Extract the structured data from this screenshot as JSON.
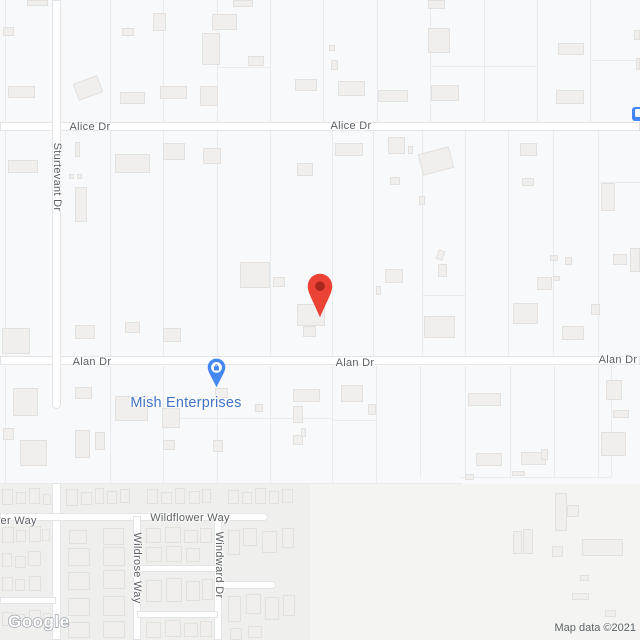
{
  "map": {
    "background": "#f8f9fa",
    "road_fill": "#ffffff",
    "road_casing": "#e3e4e6",
    "building_fill": "#f0efed",
    "building_stroke": "#e3e1de",
    "parcel_line_color": "#e9ebee",
    "street_label_color": "#5d6063"
  },
  "zones": [
    {
      "x": 0,
      "y": 484,
      "w": 640,
      "h": 156,
      "color": "#f4f5f3"
    },
    {
      "x": 0,
      "y": 484,
      "w": 310,
      "h": 156,
      "color": "#efefed"
    }
  ],
  "roads": [
    {
      "name": "Alice Dr",
      "dir": "h",
      "x": 0,
      "y": 122,
      "len": 640,
      "w": 9
    },
    {
      "name": "Alan Dr",
      "dir": "h",
      "x": 0,
      "y": 356,
      "len": 640,
      "w": 9
    },
    {
      "name": "Sturtevant Dr",
      "dir": "v",
      "x": 52,
      "y": 0,
      "len": 409,
      "w": 9,
      "cap": "end"
    },
    {
      "name": "Sturtevant Dr south",
      "dir": "v",
      "x": 52,
      "y": 483,
      "len": 157,
      "w": 9
    },
    {
      "name": "Wildflower Way",
      "dir": "h",
      "x": 0,
      "y": 513,
      "len": 268,
      "w": 8,
      "cap": "end"
    },
    {
      "name": "Wildrose Way",
      "dir": "v",
      "x": 133,
      "y": 516,
      "len": 124,
      "w": 8
    },
    {
      "name": "Windward Dr",
      "dir": "v",
      "x": 214,
      "y": 516,
      "len": 124,
      "w": 8
    },
    {
      "name": "Windward stub",
      "dir": "h",
      "x": 218,
      "y": 581,
      "len": 58,
      "w": 8,
      "cap": "end"
    },
    {
      "name": "lane north",
      "dir": "h",
      "x": 137,
      "y": 565,
      "len": 81,
      "w": 7
    },
    {
      "name": "lane south",
      "dir": "h",
      "x": 137,
      "y": 611,
      "len": 81,
      "w": 7
    },
    {
      "name": "lane west",
      "dir": "h",
      "x": 0,
      "y": 597,
      "len": 56,
      "w": 7
    }
  ],
  "road_labels": [
    {
      "text": "Alice Dr",
      "x": 90,
      "y": 127
    },
    {
      "text": "Alice Dr",
      "x": 351,
      "y": 126
    },
    {
      "text": "Sturtevant Dr",
      "x": 57,
      "y": 177,
      "vertical": true
    },
    {
      "text": "Alan Dr",
      "x": 92,
      "y": 362
    },
    {
      "text": "Alan Dr",
      "x": 355,
      "y": 363
    },
    {
      "text": "Alan Dr",
      "x": 618,
      "y": 360
    },
    {
      "text": "Wildflower Way",
      "x": -3,
      "y": 521
    },
    {
      "text": "Wildflower Way",
      "x": 190,
      "y": 518
    },
    {
      "text": "Wildrose Way",
      "x": 137,
      "y": 568,
      "vertical": true
    },
    {
      "text": "Windward Dr",
      "x": 219,
      "y": 565,
      "vertical": true
    }
  ],
  "poi": {
    "name": "Mish Enterprises",
    "label_x": 186,
    "label_y": 403,
    "label_color": "#4274c4",
    "pin_x": 207,
    "pin_y": 358,
    "pin_color": "#4688f1",
    "pin_icon": "shopping-bag"
  },
  "marker": {
    "x": 307,
    "y": 273,
    "color": "#EA4335",
    "dot_color": "#A6281C"
  },
  "transit_icon": {
    "x": 632,
    "y": 107,
    "w": 14,
    "h": 14,
    "color": "#4285f4"
  },
  "watermark": "Google",
  "attribution": "Map data ©2021",
  "parcel_lines": [
    [
      5,
      0,
      5,
      122
    ],
    [
      110,
      0,
      110,
      122
    ],
    [
      163,
      0,
      163,
      122
    ],
    [
      217,
      0,
      217,
      122
    ],
    [
      270,
      0,
      270,
      122
    ],
    [
      323,
      0,
      323,
      122
    ],
    [
      377,
      0,
      377,
      122
    ],
    [
      430,
      0,
      430,
      122
    ],
    [
      484,
      0,
      484,
      122
    ],
    [
      537,
      0,
      537,
      122
    ],
    [
      590,
      0,
      590,
      122
    ],
    [
      217,
      67,
      270,
      67
    ],
    [
      430,
      66,
      537,
      66
    ],
    [
      590,
      60,
      640,
      60
    ],
    [
      5,
      131,
      5,
      356
    ],
    [
      110,
      131,
      110,
      356
    ],
    [
      163,
      131,
      163,
      356
    ],
    [
      217,
      131,
      217,
      356
    ],
    [
      270,
      131,
      270,
      356
    ],
    [
      332,
      131,
      332,
      356
    ],
    [
      373,
      131,
      373,
      356
    ],
    [
      422,
      131,
      422,
      356
    ],
    [
      465,
      131,
      465,
      356
    ],
    [
      508,
      131,
      508,
      356
    ],
    [
      553,
      131,
      553,
      356
    ],
    [
      598,
      131,
      598,
      356
    ],
    [
      598,
      182,
      640,
      182
    ],
    [
      422,
      295,
      465,
      295
    ],
    [
      5,
      366,
      5,
      483
    ],
    [
      110,
      366,
      110,
      483
    ],
    [
      163,
      366,
      163,
      483
    ],
    [
      217,
      366,
      217,
      483
    ],
    [
      270,
      366,
      270,
      483
    ],
    [
      332,
      366,
      332,
      483
    ],
    [
      376,
      366,
      376,
      483
    ],
    [
      420,
      366,
      420,
      477
    ],
    [
      465,
      366,
      465,
      477
    ],
    [
      510,
      366,
      510,
      477
    ],
    [
      554,
      366,
      554,
      477
    ],
    [
      598,
      366,
      598,
      477
    ],
    [
      611,
      366,
      611,
      477
    ],
    [
      163,
      418,
      332,
      418
    ],
    [
      332,
      420,
      376,
      420
    ],
    [
      460,
      477,
      611,
      477
    ],
    [
      0,
      483,
      462,
      483
    ]
  ],
  "buildings": [
    [
      27,
      0,
      21,
      6
    ],
    [
      233,
      0,
      20,
      7
    ],
    [
      428,
      0,
      17,
      9
    ],
    [
      3,
      27,
      11,
      9
    ],
    [
      8,
      86,
      27,
      12
    ],
    [
      122,
      28,
      12,
      8
    ],
    [
      120,
      92,
      25,
      12
    ],
    [
      153,
      13,
      13,
      18
    ],
    [
      75,
      79,
      26,
      18,
      -20
    ],
    [
      160,
      86,
      27,
      13
    ],
    [
      202,
      33,
      18,
      32
    ],
    [
      212,
      14,
      25,
      16
    ],
    [
      200,
      86,
      18,
      20
    ],
    [
      248,
      56,
      16,
      10
    ],
    [
      295,
      79,
      22,
      12
    ],
    [
      428,
      28,
      22,
      25
    ],
    [
      329,
      45,
      6,
      6
    ],
    [
      331,
      60,
      7,
      10
    ],
    [
      338,
      81,
      27,
      15
    ],
    [
      378,
      90,
      30,
      12
    ],
    [
      431,
      85,
      28,
      16
    ],
    [
      558,
      43,
      26,
      12
    ],
    [
      556,
      90,
      28,
      14
    ],
    [
      634,
      30,
      6,
      10
    ],
    [
      636,
      58,
      4,
      12
    ],
    [
      8,
      160,
      30,
      13
    ],
    [
      75,
      142,
      5,
      15
    ],
    [
      69,
      174,
      5,
      5
    ],
    [
      77,
      174,
      5,
      5
    ],
    [
      75,
      187,
      12,
      35
    ],
    [
      115,
      154,
      35,
      19
    ],
    [
      163,
      143,
      22,
      17
    ],
    [
      203,
      148,
      18,
      16
    ],
    [
      297,
      163,
      16,
      13
    ],
    [
      335,
      143,
      28,
      13
    ],
    [
      388,
      137,
      17,
      17
    ],
    [
      408,
      146,
      5,
      8
    ],
    [
      420,
      150,
      32,
      22,
      -15
    ],
    [
      390,
      177,
      10,
      8
    ],
    [
      419,
      196,
      6,
      9
    ],
    [
      520,
      143,
      17,
      13
    ],
    [
      522,
      178,
      12,
      8
    ],
    [
      601,
      183,
      14,
      28
    ],
    [
      240,
      262,
      30,
      26
    ],
    [
      273,
      277,
      12,
      10
    ],
    [
      297,
      304,
      28,
      22
    ],
    [
      303,
      326,
      13,
      11
    ],
    [
      385,
      269,
      18,
      14
    ],
    [
      376,
      286,
      5,
      9
    ],
    [
      437,
      250,
      7,
      10,
      20
    ],
    [
      438,
      264,
      9,
      13
    ],
    [
      424,
      316,
      31,
      22
    ],
    [
      513,
      303,
      25,
      21
    ],
    [
      562,
      326,
      22,
      14
    ],
    [
      591,
      304,
      9,
      11
    ],
    [
      537,
      277,
      15,
      13
    ],
    [
      550,
      255,
      8,
      6
    ],
    [
      565,
      257,
      7,
      8
    ],
    [
      553,
      276,
      7,
      5
    ],
    [
      613,
      254,
      14,
      11
    ],
    [
      630,
      248,
      10,
      24
    ],
    [
      75,
      325,
      20,
      14
    ],
    [
      125,
      322,
      15,
      11
    ],
    [
      163,
      328,
      18,
      14
    ],
    [
      2,
      328,
      28,
      26
    ],
    [
      13,
      388,
      25,
      28
    ],
    [
      3,
      428,
      11,
      12
    ],
    [
      20,
      440,
      27,
      26
    ],
    [
      75,
      387,
      17,
      12
    ],
    [
      75,
      430,
      15,
      28
    ],
    [
      95,
      432,
      10,
      18
    ],
    [
      163,
      440,
      12,
      10
    ],
    [
      115,
      396,
      33,
      25
    ],
    [
      162,
      408,
      18,
      20
    ],
    [
      215,
      388,
      13,
      10
    ],
    [
      213,
      440,
      10,
      12
    ],
    [
      255,
      404,
      8,
      8
    ],
    [
      293,
      406,
      10,
      17
    ],
    [
      293,
      435,
      10,
      10
    ],
    [
      293,
      389,
      27,
      13
    ],
    [
      341,
      385,
      22,
      17
    ],
    [
      368,
      404,
      8,
      11
    ],
    [
      301,
      428,
      5,
      9
    ],
    [
      468,
      393,
      33,
      13
    ],
    [
      476,
      453,
      26,
      13
    ],
    [
      521,
      452,
      25,
      13
    ],
    [
      541,
      449,
      7,
      11
    ],
    [
      512,
      471,
      13,
      5
    ],
    [
      465,
      474,
      9,
      6
    ],
    [
      606,
      380,
      16,
      20
    ],
    [
      613,
      410,
      16,
      8
    ],
    [
      601,
      432,
      25,
      24
    ],
    [
      555,
      493,
      12,
      38
    ],
    [
      567,
      505,
      12,
      12
    ],
    [
      513,
      531,
      9,
      23
    ],
    [
      523,
      529,
      10,
      25
    ],
    [
      552,
      546,
      11,
      11
    ],
    [
      582,
      539,
      41,
      17
    ],
    [
      580,
      575,
      9,
      6
    ],
    [
      572,
      593,
      17,
      7
    ],
    [
      605,
      610,
      11,
      7
    ],
    [
      2,
      489,
      11,
      16
    ],
    [
      16,
      492,
      10,
      12
    ],
    [
      29,
      488,
      11,
      16
    ],
    [
      43,
      494,
      8,
      11
    ],
    [
      66,
      489,
      12,
      17
    ],
    [
      81,
      492,
      11,
      13
    ],
    [
      95,
      488,
      9,
      16
    ],
    [
      107,
      491,
      10,
      13
    ],
    [
      120,
      489,
      10,
      14
    ],
    [
      147,
      489,
      11,
      15
    ],
    [
      161,
      492,
      11,
      12
    ],
    [
      175,
      488,
      10,
      16
    ],
    [
      189,
      491,
      11,
      13
    ],
    [
      202,
      489,
      9,
      14
    ],
    [
      228,
      490,
      11,
      14
    ],
    [
      242,
      492,
      10,
      12
    ],
    [
      255,
      488,
      11,
      16
    ],
    [
      269,
      491,
      10,
      13
    ],
    [
      282,
      489,
      11,
      14
    ],
    [
      2,
      527,
      12,
      16
    ],
    [
      16,
      530,
      10,
      12
    ],
    [
      29,
      526,
      12,
      16
    ],
    [
      42,
      529,
      8,
      12
    ],
    [
      2,
      553,
      10,
      14
    ],
    [
      15,
      556,
      11,
      12
    ],
    [
      28,
      551,
      13,
      15
    ],
    [
      2,
      577,
      11,
      14
    ],
    [
      15,
      579,
      10,
      12
    ],
    [
      29,
      576,
      12,
      15
    ],
    [
      2,
      612,
      11,
      14
    ],
    [
      15,
      614,
      10,
      12
    ],
    [
      29,
      610,
      12,
      16
    ],
    [
      43,
      613,
      8,
      11
    ],
    [
      69,
      530,
      18,
      14
    ],
    [
      103,
      528,
      21,
      17
    ],
    [
      68,
      548,
      22,
      18
    ],
    [
      103,
      547,
      22,
      19
    ],
    [
      68,
      572,
      22,
      18
    ],
    [
      103,
      570,
      22,
      19
    ],
    [
      68,
      598,
      22,
      18
    ],
    [
      103,
      596,
      22,
      20
    ],
    [
      68,
      622,
      22,
      16
    ],
    [
      103,
      621,
      22,
      17
    ],
    [
      146,
      528,
      15,
      15
    ],
    [
      165,
      527,
      16,
      16
    ],
    [
      184,
      530,
      14,
      13
    ],
    [
      200,
      528,
      12,
      15
    ],
    [
      146,
      547,
      16,
      15
    ],
    [
      166,
      546,
      16,
      16
    ],
    [
      186,
      548,
      14,
      14
    ],
    [
      146,
      580,
      16,
      22
    ],
    [
      166,
      578,
      16,
      24
    ],
    [
      186,
      581,
      14,
      20
    ],
    [
      202,
      579,
      11,
      21
    ],
    [
      146,
      622,
      15,
      16
    ],
    [
      165,
      620,
      16,
      17
    ],
    [
      184,
      623,
      14,
      14
    ],
    [
      200,
      621,
      12,
      16
    ],
    [
      228,
      530,
      12,
      25
    ],
    [
      243,
      528,
      14,
      18
    ],
    [
      262,
      531,
      15,
      22
    ],
    [
      282,
      528,
      12,
      20
    ],
    [
      228,
      596,
      13,
      26
    ],
    [
      246,
      594,
      15,
      20
    ],
    [
      265,
      597,
      14,
      23
    ],
    [
      283,
      595,
      12,
      21
    ],
    [
      230,
      628,
      12,
      12
    ],
    [
      248,
      626,
      14,
      12
    ]
  ]
}
